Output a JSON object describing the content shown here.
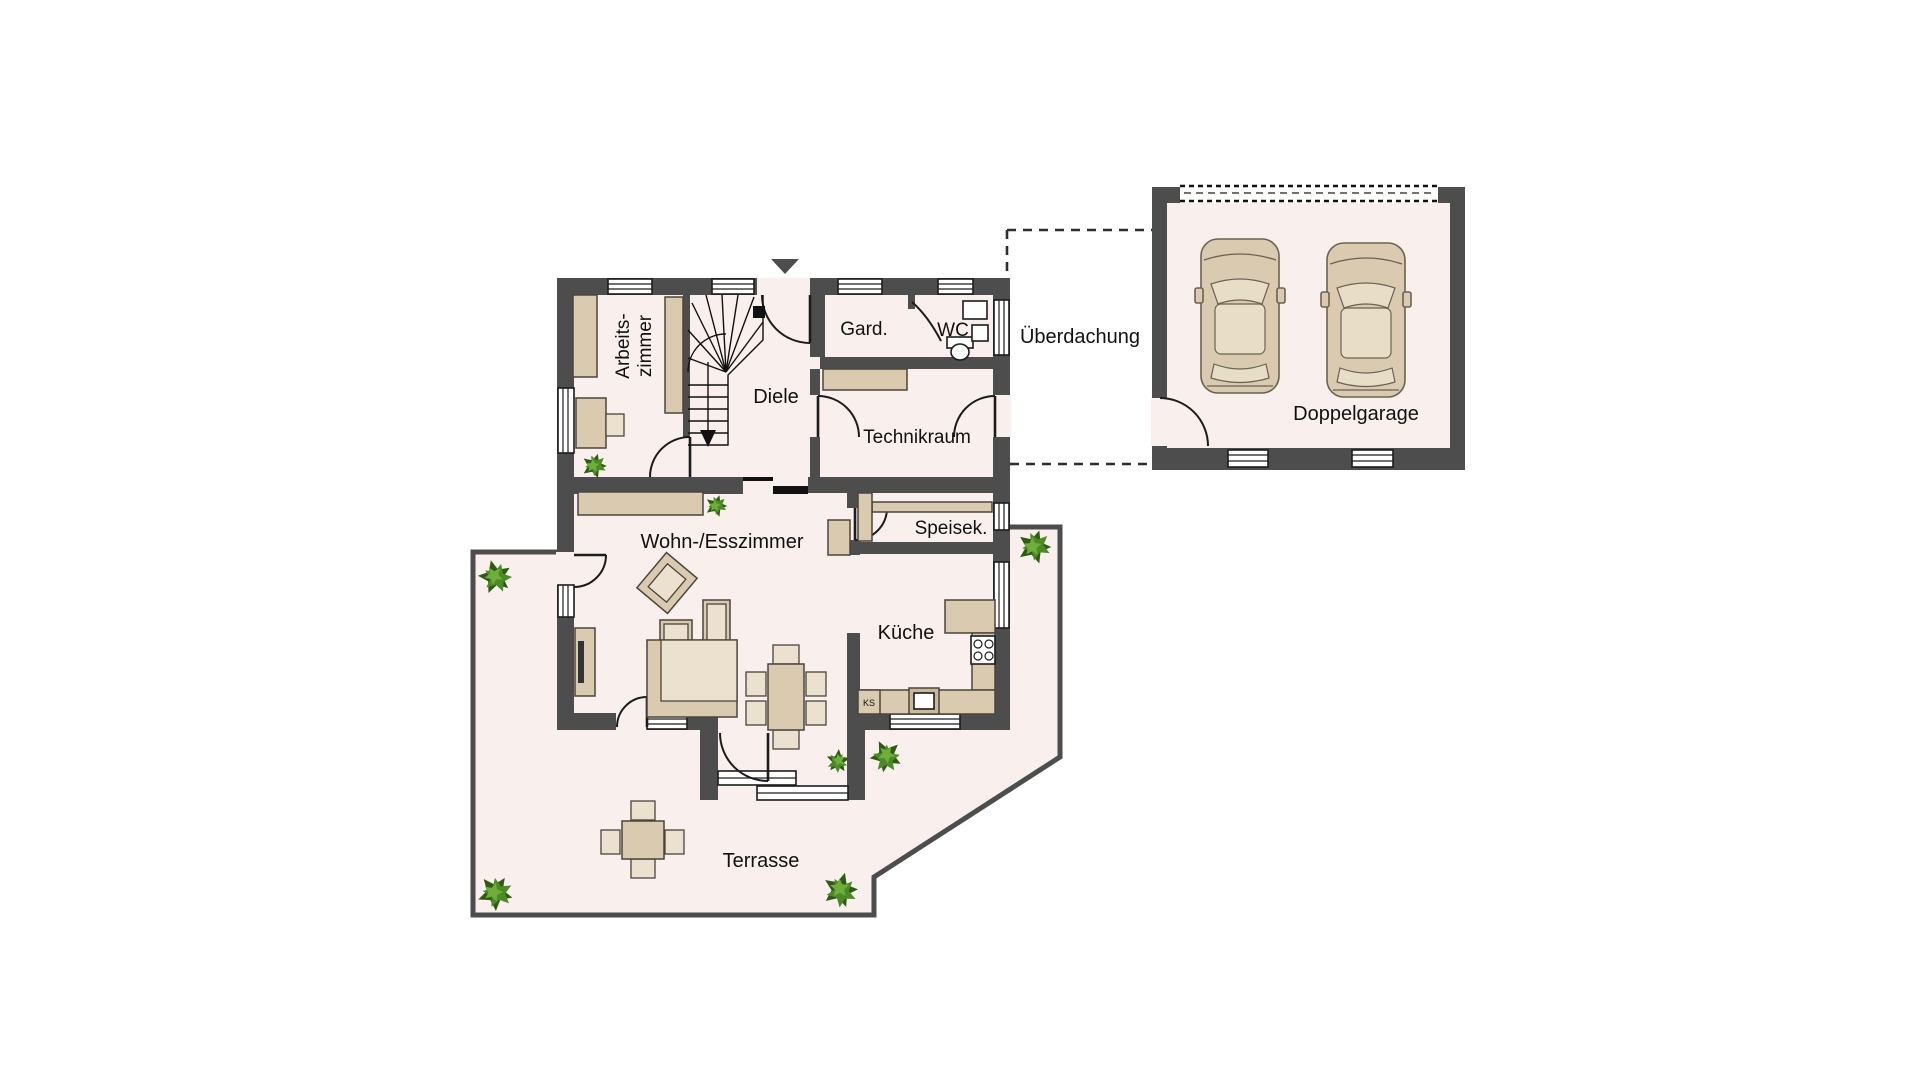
{
  "figure": {
    "type": "floor-plan",
    "floor": "Erdgeschoss"
  },
  "colors": {
    "background": "#ffffff",
    "floor": "#f9efec",
    "wall": "#4d4d4d",
    "furniture": "#d9cab0",
    "furniture_light": "#ece1cf",
    "plant_dark": "#2e5c14",
    "plant_mid": "#4c8a28",
    "plant_light": "#6fae3a"
  },
  "rooms": {
    "arbeitszimmer": {
      "label_line1": "Arbeits-",
      "label_line2": "zimmer"
    },
    "diele": {
      "label": "Diele"
    },
    "garderobe": {
      "label": "Gard."
    },
    "wc": {
      "label": "WC"
    },
    "technikraum": {
      "label": "Technikraum"
    },
    "ueberdachung": {
      "label": "Überdachung"
    },
    "doppelgarage": {
      "label": "Doppelgarage"
    },
    "wohn_esszimmer": {
      "label": "Wohn-/Esszimmer"
    },
    "speisekammer": {
      "label": "Speisek."
    },
    "kueche": {
      "label": "Küche"
    },
    "kuehlschrank": {
      "label": "KS"
    },
    "terrasse": {
      "label": "Terrasse"
    }
  }
}
